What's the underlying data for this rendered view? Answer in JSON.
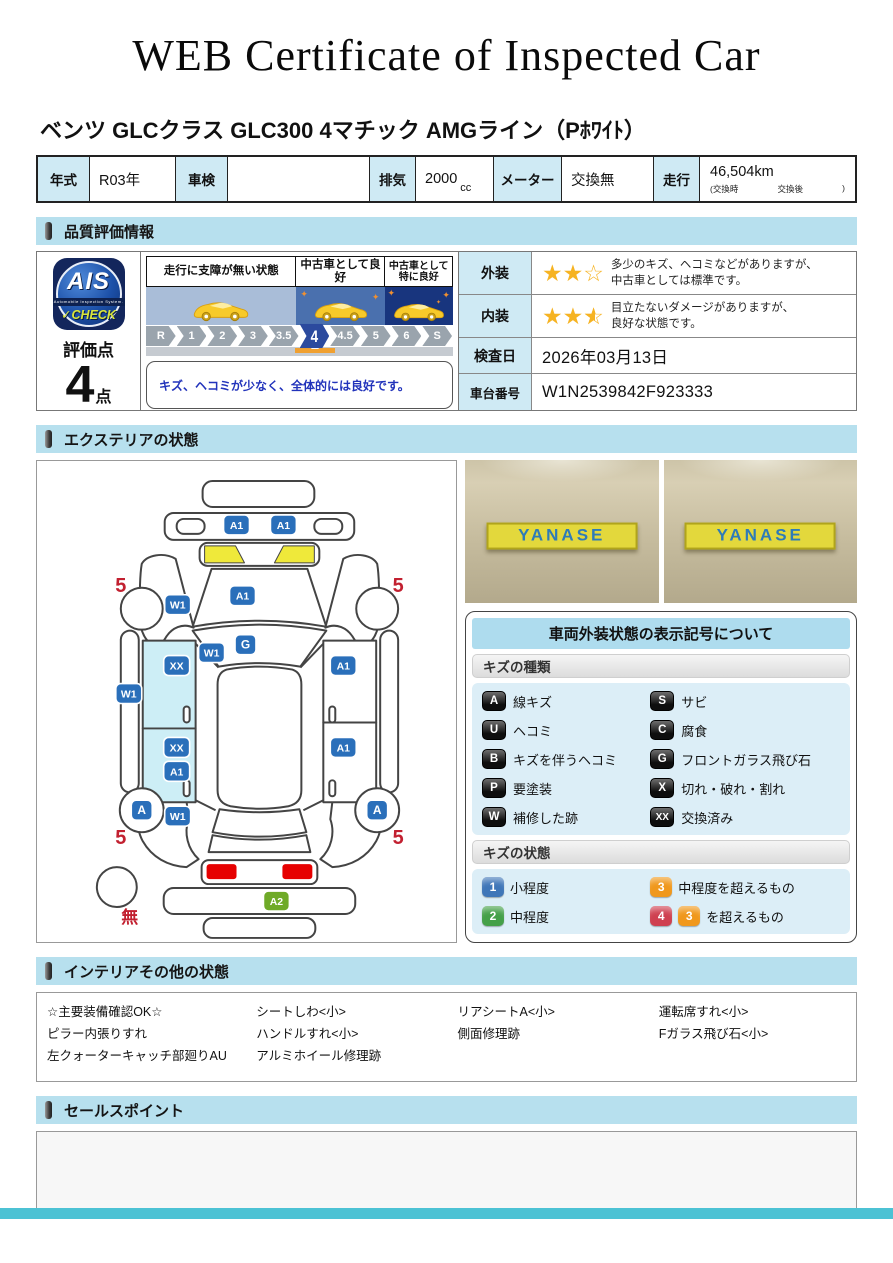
{
  "title": "WEB Certificate of Inspected Car",
  "car_title": "ベンツ GLCクラス GLC300 4マチック AMGライン（Pﾎﾜｲﾄ）",
  "colors": {
    "header_blue": "#b7e0ee",
    "label_cyan": "#cfeaf4",
    "marker_blue": "#2a6fba",
    "marker_green": "#6faa28",
    "red": "#c22030",
    "star_gold": "#f6b322",
    "door_highlight": "#cdeef6",
    "cowl_yellow": "#efe93a",
    "taillight_red": "#e60000",
    "footer_teal": "#4cc2d4"
  },
  "spec": {
    "year_label": "年式",
    "year_value": "R03年",
    "inspection_label": "車検",
    "inspection_value": "",
    "displacement_label": "排気",
    "displacement_value": "2000",
    "displacement_unit": "cc",
    "meter_label": "メーター",
    "meter_value": "交換無",
    "mileage_label": "走行",
    "mileage_value": "46,504km",
    "mileage_note_left": "(交換時",
    "mileage_note_mid": "交換後",
    "mileage_note_right": ")"
  },
  "sections": {
    "quality": "品質評価情報",
    "exterior": "エクステリアの状態",
    "interior": "インテリアその他の状態",
    "sales": "セールスポイント"
  },
  "evaluation": {
    "logo": {
      "ais": "AIS",
      "sub": "Automobile Inspection System.",
      "check": "✓CHECK"
    },
    "score_label": "評価点",
    "score": "4",
    "score_unit": "点",
    "scale_bands": [
      {
        "label": "走行に支障が無い状態",
        "label2": ""
      },
      {
        "label": "中古車として良好",
        "label2": ""
      },
      {
        "label": "中古車として",
        "label2": "特に良好"
      }
    ],
    "scale_ticks": [
      "R",
      "1",
      "2",
      "3",
      "3.5",
      "4",
      "4.5",
      "5",
      "6",
      "S"
    ],
    "selected_tick": "4",
    "comment": "キズ、ヘコミが少なく、全体的には良好です。",
    "rows": {
      "exterior_label": "外装",
      "exterior_stars": 2,
      "stars_max": 3,
      "exterior_text1": "多少のキズ、ヘコミなどがありますが、",
      "exterior_text2": "中古車としては標準です。",
      "interior_label": "内装",
      "interior_stars": 2.5,
      "interior_text1": "目立たないダメージがありますが、",
      "interior_text2": "良好な状態です。",
      "date_label": "検査日",
      "date_value": "2026年03月13日",
      "vin_label": "車台番号",
      "vin_value": "W1N2539842F923333"
    }
  },
  "diagram": {
    "markers": [
      {
        "code": "A1",
        "x": 200,
        "y": 64
      },
      {
        "code": "A1",
        "x": 247,
        "y": 64
      },
      {
        "code": "A1",
        "x": 206,
        "y": 135
      },
      {
        "code": "W1",
        "x": 141,
        "y": 144
      },
      {
        "code": "G",
        "x": 209,
        "y": 184
      },
      {
        "code": "W1",
        "x": 175,
        "y": 192
      },
      {
        "code": "XX",
        "x": 140,
        "y": 205
      },
      {
        "code": "W1",
        "x": 92,
        "y": 233
      },
      {
        "code": "XX",
        "x": 140,
        "y": 287
      },
      {
        "code": "A1",
        "x": 140,
        "y": 311
      },
      {
        "code": "A1",
        "x": 307,
        "y": 205
      },
      {
        "code": "A1",
        "x": 307,
        "y": 287
      },
      {
        "code": "A",
        "x": 105,
        "y": 350
      },
      {
        "code": "A",
        "x": 341,
        "y": 350
      },
      {
        "code": "W1",
        "x": 141,
        "y": 356
      },
      {
        "code": "A2",
        "x": 240,
        "y": 441,
        "color": "#6faa28"
      }
    ],
    "labels": [
      {
        "text": "5",
        "x": 84,
        "y": 131,
        "name": "tire-depth-front-left"
      },
      {
        "text": "5",
        "x": 362,
        "y": 131,
        "name": "tire-depth-front-right"
      },
      {
        "text": "5",
        "x": 84,
        "y": 384,
        "name": "tire-depth-rear-left"
      },
      {
        "text": "5",
        "x": 362,
        "y": 384,
        "name": "tire-depth-rear-right"
      },
      {
        "text": "無",
        "x": 93,
        "y": 463,
        "size": 17,
        "name": "spare-tire-none"
      }
    ]
  },
  "photos": {
    "left_sign": "YANASE",
    "right_sign": "YANASE"
  },
  "legend": {
    "title": "車両外装状態の表示記号について",
    "kind_header": "キズの種類",
    "kinds": [
      {
        "code": "A",
        "label": "線キズ"
      },
      {
        "code": "S",
        "label": "サビ"
      },
      {
        "code": "U",
        "label": "ヘコミ"
      },
      {
        "code": "C",
        "label": "腐食"
      },
      {
        "code": "B",
        "label": "キズを伴うヘコミ"
      },
      {
        "code": "G",
        "label": "フロントガラス飛び石"
      },
      {
        "code": "P",
        "label": "要塗装"
      },
      {
        "code": "X",
        "label": "切れ・破れ・割れ"
      },
      {
        "code": "W",
        "label": "補修した跡"
      },
      {
        "code": "XX",
        "label": "交換済み"
      }
    ],
    "state_header": "キズの状態",
    "states": [
      {
        "badges": [
          {
            "code": "1",
            "color": "#3f76b8"
          }
        ],
        "label": "小程度"
      },
      {
        "badges": [
          {
            "code": "3",
            "color": "#f0981c"
          }
        ],
        "label": "中程度を超えるもの"
      },
      {
        "badges": [
          {
            "code": "2",
            "color": "#44a048"
          }
        ],
        "label": "中程度"
      },
      {
        "badges": [
          {
            "code": "4",
            "color": "#cf4050"
          },
          {
            "code": "3",
            "color": "#f0981c"
          }
        ],
        "label": "を超えるもの"
      }
    ]
  },
  "interior_notes": {
    "columns": [
      [
        "☆主要装備確認OK☆",
        "ピラー内張りすれ",
        "左クォーターキャッチ部廻りAU"
      ],
      [
        "シートしわ<小>",
        "ハンドルすれ<小>",
        "アルミホイール修理跡"
      ],
      [
        "リアシートA<小>",
        "側面修理跡"
      ],
      [
        "運転席すれ<小>",
        "Fガラス飛び石<小>"
      ]
    ]
  }
}
